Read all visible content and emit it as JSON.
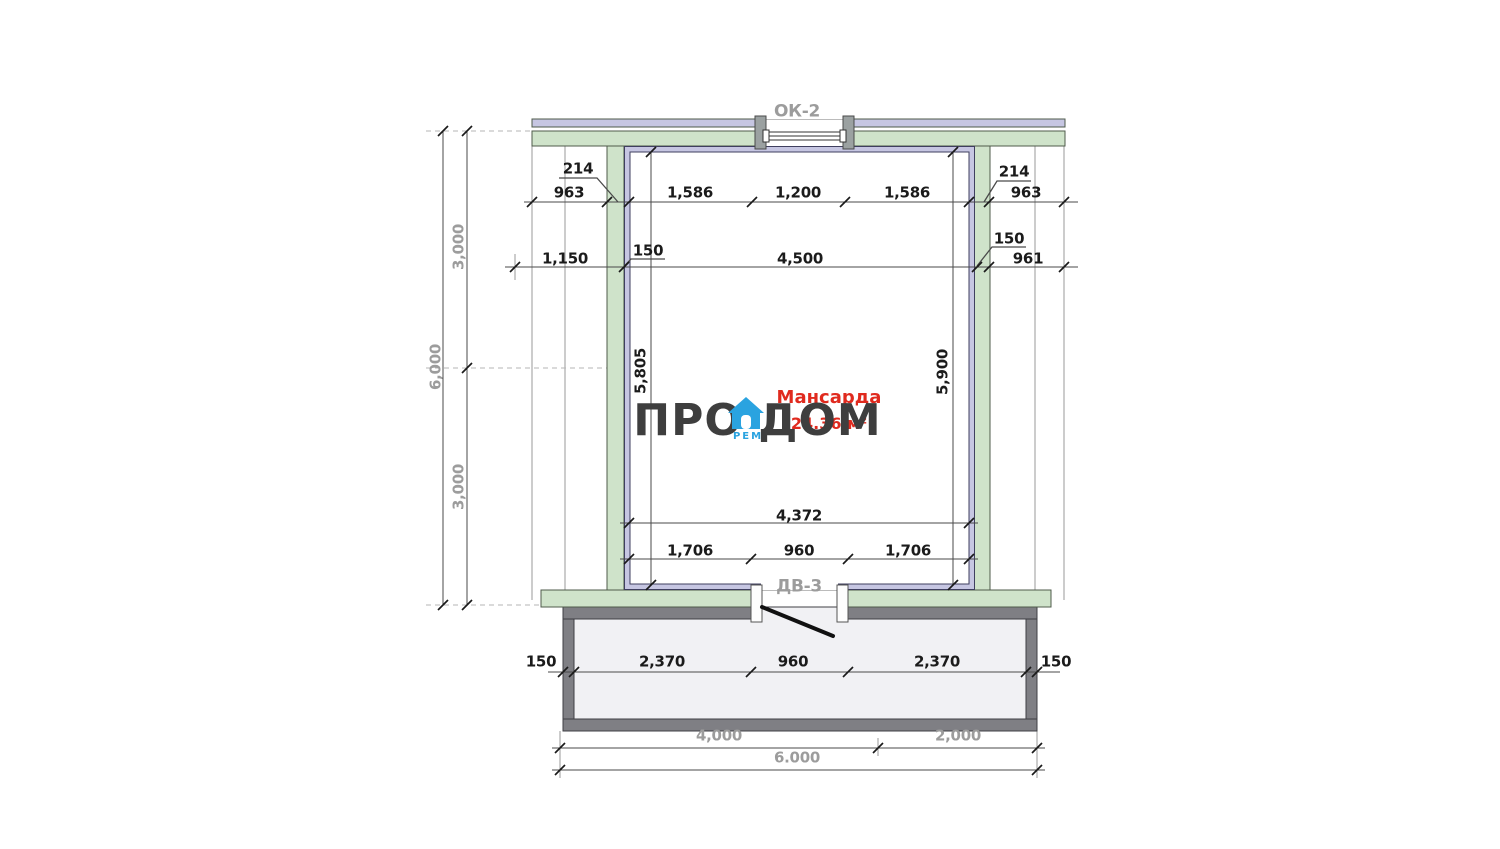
{
  "brand": {
    "left": "ПРО",
    "right": "ДОМ",
    "sub": "РЕМ"
  },
  "room": {
    "name": "Мансарда",
    "area": "24.36 м²"
  },
  "openings": {
    "window": "ОК-2",
    "door": "ДВ-3"
  },
  "dims": {
    "row1": {
      "left_ext": "963",
      "leader_left": "214",
      "seg1": "1,586",
      "seg2": "1,200",
      "seg3": "1,586",
      "leader_right": "214",
      "right_ext": "963"
    },
    "row2": {
      "left": "1,150",
      "leader_left": "150",
      "center": "4,500",
      "leader_right": "150",
      "right": "961"
    },
    "left_col": {
      "total": "6,000",
      "upper": "3,000",
      "lower": "3,000"
    },
    "room_heights": {
      "left": "5,805",
      "right": "5,900"
    },
    "row3": "4,372",
    "row4": {
      "seg1": "1,706",
      "seg2": "960",
      "seg3": "1,706"
    },
    "row5": {
      "wall_left": "150",
      "seg1": "2,370",
      "seg2": "960",
      "seg3": "2,370",
      "wall_right": "150"
    },
    "row6": {
      "seg1": "4,000",
      "seg2": "2,000"
    },
    "row7": "6.000"
  },
  "colors": {
    "wall_green": "#cfe3ca",
    "lining_lavender": "#c6c6e2",
    "annex_gray": "#7f7f84",
    "accent_red": "#e02a1e",
    "brand_blue": "#2aa3e0"
  }
}
